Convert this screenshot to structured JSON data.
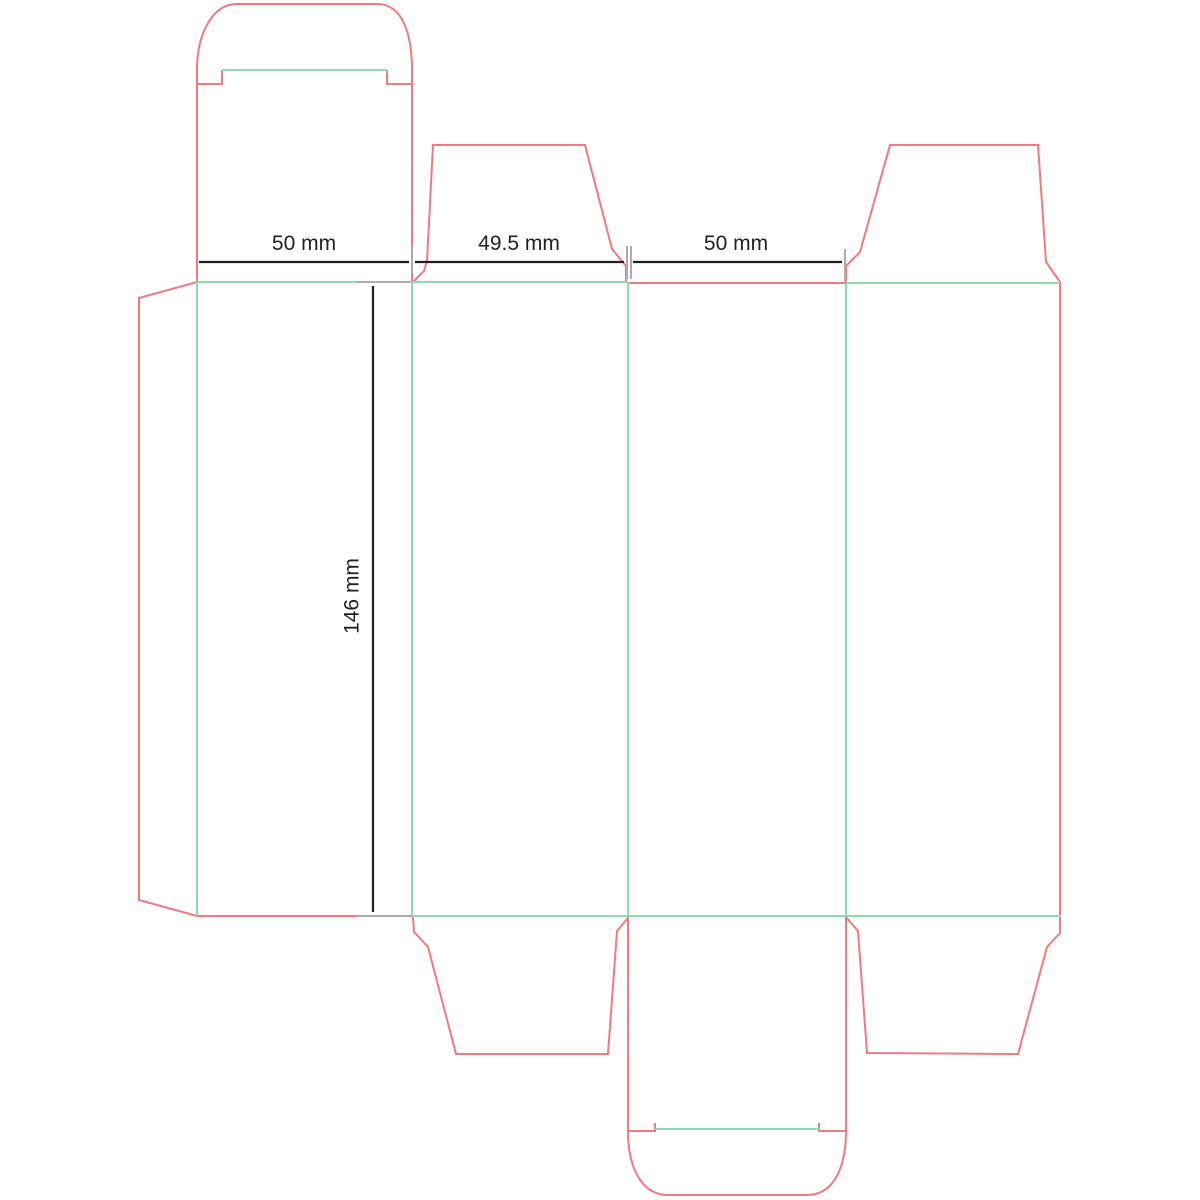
{
  "document": {
    "type": "packaging-dieline-template",
    "description": "Tuck end box dieline with cut and fold lines"
  },
  "colors": {
    "cut": "#F17A7E",
    "fold": "#90DAB0",
    "dim": "#231F20",
    "ext": "#ACACAC",
    "background": "#FFFFFF"
  },
  "dimensions": {
    "panel1_width": {
      "label": "50 mm"
    },
    "panel2_width": {
      "label": "49.5 mm"
    },
    "panel3_width": {
      "label": "50 mm"
    },
    "body_height": {
      "label": "146 mm"
    }
  },
  "dieline": {
    "paths": [
      {
        "role": "cut",
        "name": "top-tuck-flap-outline",
        "d": "M 197 66 C 198 34 212 4 237 4 L 377 4 C 403 4 411 34 412 66"
      },
      {
        "role": "cut",
        "name": "top-tuck-slit-left",
        "d": "M 197 66 L 197 84 L 222 84 L 222 70"
      },
      {
        "role": "cut",
        "name": "top-tuck-slit-right",
        "d": "M 412 66 L 412 84 L 387 84 L 387 70"
      },
      {
        "role": "cut",
        "name": "top-lid-left-edge",
        "d": "M 197 66 L 197 282"
      },
      {
        "role": "cut",
        "name": "top-lid-right-edge",
        "d": "M 412 66 L 412 282"
      },
      {
        "role": "cut",
        "name": "glue-flap-outline",
        "d": "M 197 282 L 139 298 L 139 900 L 197 916"
      },
      {
        "role": "cut",
        "name": "panel1-bottom-cut",
        "d": "M 197 916 L 412 916"
      },
      {
        "role": "cut",
        "name": "top-dust-flap-left-outline",
        "d": "M 413 282 L 424 271 L 427 261 L 433 145 L 585 145 L 612 249 L 626 266 L 626 282"
      },
      {
        "role": "cut",
        "name": "panel3-top-cut",
        "d": "M 628 283 L 846 283"
      },
      {
        "role": "cut",
        "name": "top-dust-flap-right-outline",
        "d": "M 846 283 L 846 266 L 860 252 L 890 145 L 1038 145 L 1046 262 L 1060 282"
      },
      {
        "role": "cut",
        "name": "panel4-right-edge",
        "d": "M 1060 282 L 1060 916"
      },
      {
        "role": "cut",
        "name": "bottom-dust-flap-left-outline",
        "d": "M 413 917 L 414 932 L 428 947 L 456 1054 L 608 1054 L 617 931 L 628 918"
      },
      {
        "role": "cut",
        "name": "bottom-dust-flap-right-outline",
        "d": "M 846 917 L 858 931 L 867 1053 L 1018 1054 L 1047 947 L 1060 933 L 1060 917"
      },
      {
        "role": "cut",
        "name": "bottom-lid-left-edge",
        "d": "M 628 917 L 628 1131"
      },
      {
        "role": "cut",
        "name": "bottom-lid-right-edge",
        "d": "M 846 917 L 846 1131"
      },
      {
        "role": "cut",
        "name": "bottom-tuck-slit-left",
        "d": "M 628 1131 L 655 1131 L 655 1123"
      },
      {
        "role": "cut",
        "name": "bottom-tuck-slit-right",
        "d": "M 846 1131 L 819 1131 L 819 1123"
      },
      {
        "role": "cut",
        "name": "bottom-tuck-flap-outline",
        "d": "M 628 1131 C 628 1163 639 1195 668 1195 L 807 1195 C 836 1195 846 1163 846 1131"
      },
      {
        "role": "fold",
        "name": "top-tuck-fold",
        "d": "M 222 70 L 387 70"
      },
      {
        "role": "fold",
        "name": "top-body-fold-left",
        "d": "M 197 282 L 628 282"
      },
      {
        "role": "fold",
        "name": "top-body-fold-right",
        "d": "M 846 283 L 1060 283"
      },
      {
        "role": "fold",
        "name": "glue-flap-fold",
        "d": "M 197 282 L 197 916"
      },
      {
        "role": "fold",
        "name": "panel1-panel2-fold",
        "d": "M 412 282 L 412 916"
      },
      {
        "role": "fold",
        "name": "panel2-panel3-fold",
        "d": "M 628 282 L 628 916"
      },
      {
        "role": "fold",
        "name": "panel3-panel4-fold",
        "d": "M 846 283 L 846 917"
      },
      {
        "role": "fold",
        "name": "bottom-body-fold",
        "d": "M 412 916 L 1060 916"
      },
      {
        "role": "fold",
        "name": "bottom-tuck-fold",
        "d": "M 655 1129 L 819 1129"
      },
      {
        "role": "ext",
        "name": "ext-line-x412",
        "d": "M 412 246 L 412 273"
      },
      {
        "role": "ext",
        "name": "ext-line-x627",
        "d": "M 627 246 L 627 279"
      },
      {
        "role": "ext",
        "name": "ext-line-x631",
        "d": "M 631 246 L 631 279"
      },
      {
        "role": "ext",
        "name": "ext-line-x845",
        "d": "M 845 249 L 845 281"
      },
      {
        "role": "ext",
        "name": "ext-line-y282",
        "d": "M 357 282 L 410 282"
      },
      {
        "role": "ext",
        "name": "ext-line-y916",
        "d": "M 357 916 L 410 916"
      },
      {
        "role": "dim",
        "name": "dim-line-panel1-width",
        "d": "M 199 262 L 409 262"
      },
      {
        "role": "dim",
        "name": "dim-line-panel2-width",
        "d": "M 415 262 L 624 262"
      },
      {
        "role": "dim",
        "name": "dim-line-panel3-width",
        "d": "M 633 262 L 842 262"
      },
      {
        "role": "dim",
        "name": "dim-line-body-height",
        "d": "M 373 286 L 373 912"
      }
    ]
  }
}
